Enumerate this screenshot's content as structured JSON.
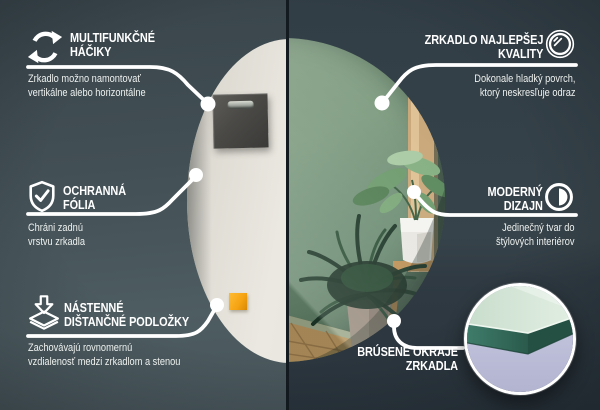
{
  "colors": {
    "background_left": "#46535a",
    "background_right": "#2e3941",
    "divider": "#141b20",
    "line_and_text": "#ffffff",
    "mirror_wall_green": "#7e9a81",
    "mirror_back_cream": "#e9e6df",
    "hook_plate_gray": "#4a4946",
    "spacer_pad_orange": "#f5a312",
    "inset_lavender": "#c5c7e0",
    "glass_edge_teal": "#3d7a68",
    "wood_floor": "#b5945f"
  },
  "callouts": {
    "hooks": {
      "icon": "rotate-arrows-icon",
      "title1": "MULTIFUNKČNÉ",
      "title2": "HÁČIKY",
      "desc1": "Zrkadlo možno namontovať",
      "desc2": "vertikálne alebo horizontálne"
    },
    "film": {
      "icon": "shield-check-icon",
      "title1": "OCHRANNÁ",
      "title2": "FÓLIA",
      "desc1": "Chráni zadnú",
      "desc2": "vrstvu zrkadla"
    },
    "spacers": {
      "icon": "spacer-stack-icon",
      "title1": "NÁSTENNÉ",
      "title2": "DIŠTANČNÉ PODLOŽKY",
      "desc1": "Zachovávajú rovnomernú",
      "desc2": "vzdialenosť medzi zrkadlom a stenou"
    },
    "quality": {
      "icon": "mirror-circle-icon",
      "title1": "ZRKADLO NAJLEPŠEJ",
      "title2": "KVALITY",
      "desc1": "Dokonale hladký povrch,",
      "desc2": "ktorý neskresľuje odraz"
    },
    "design": {
      "icon": "half-circle-icon",
      "title1": "MODERNÝ",
      "title2": "DIZAJN",
      "desc1": "Jedinečný tvar do",
      "desc2": "štýlových interiérov"
    },
    "edges": {
      "icon": "glass-edge-photo",
      "title1": "BRÚSENÉ OKRAJE",
      "title2": "ZRKADLA"
    }
  }
}
